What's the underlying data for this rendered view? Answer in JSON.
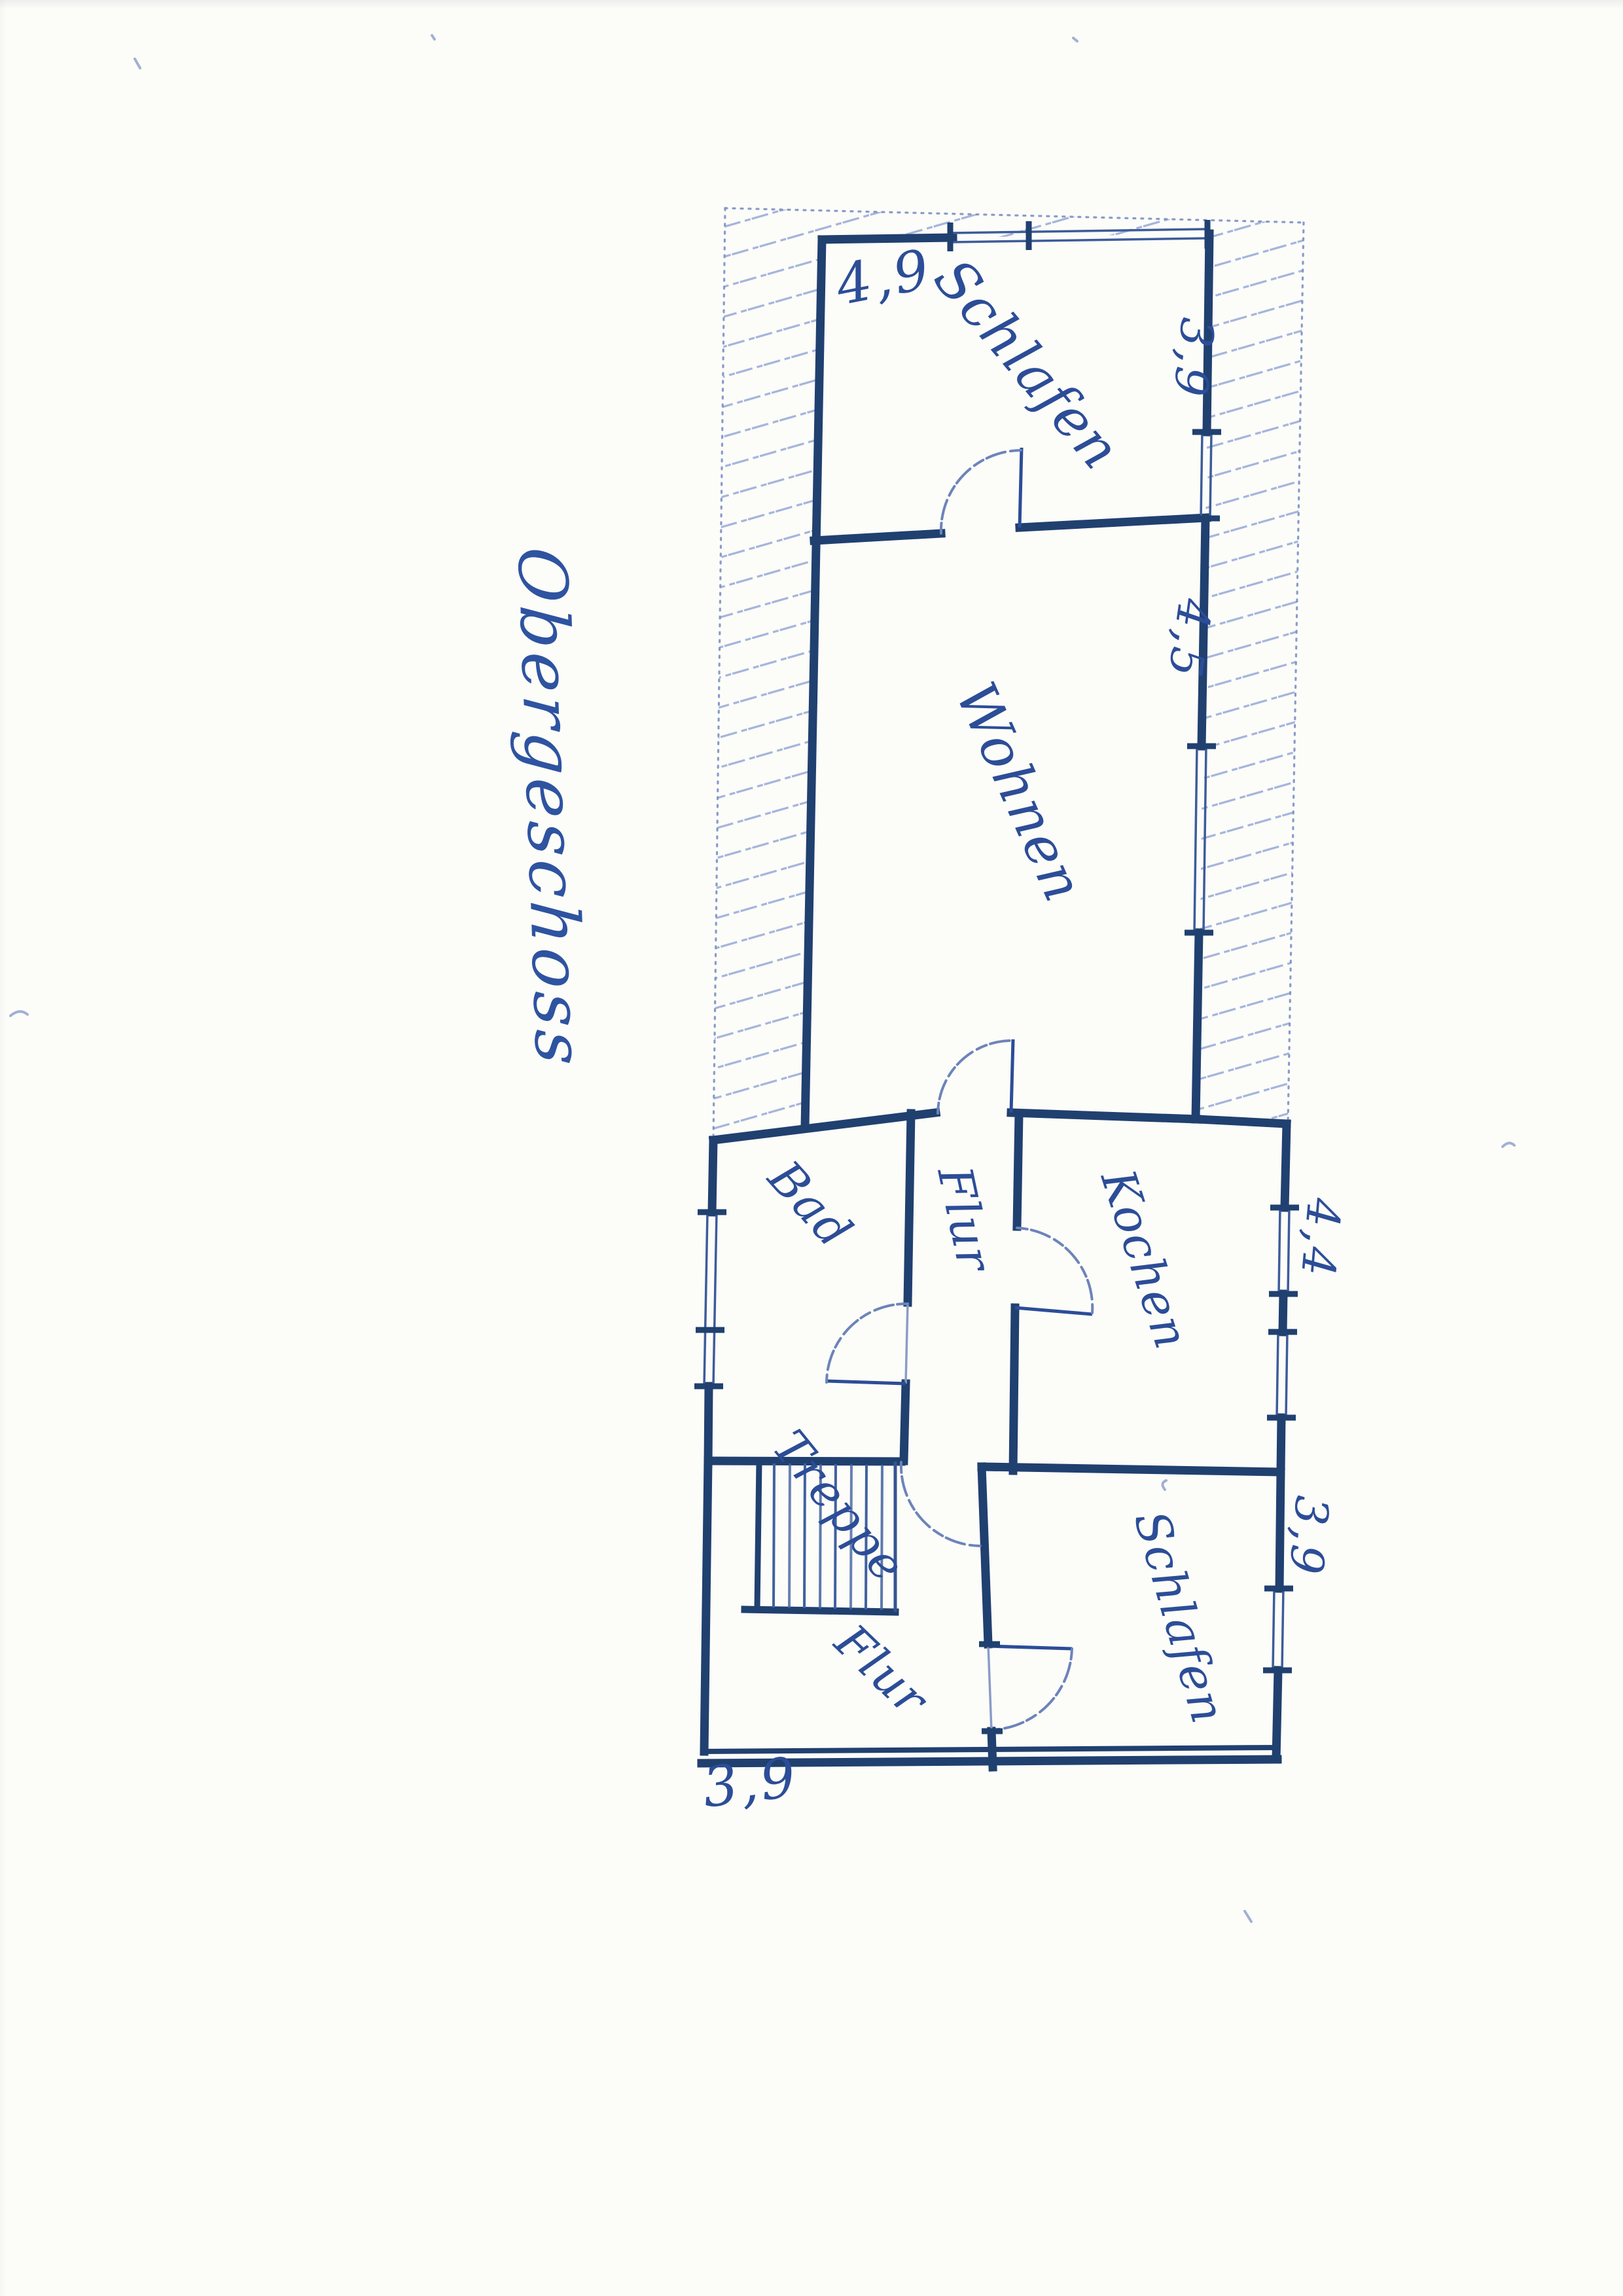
{
  "title": "Obergeschoss",
  "rooms": {
    "schlafen_top": "Schlafen",
    "wohnen": "Wohnen",
    "bad": "Bad",
    "flur_mitte": "Flur",
    "kochen": "Kochen",
    "treppe": "Treppe",
    "flur_unten": "Flur",
    "schlafen_unten": "Schlafen"
  },
  "dimensions": {
    "top_width": "4,9",
    "schlafen_top_depth": "3,9",
    "wohnen_depth": "4,5",
    "kochen_depth": "4,4",
    "schlafen_unten_depth": "3,9",
    "bottom_width": "3,9"
  },
  "ink": {
    "wall_color": "#20406f",
    "handwriting_color": "#2c4d97",
    "hatch_color": "#8fa2d4",
    "outline_color": "#7b90c4",
    "paper_color": "#fcfcf9"
  }
}
